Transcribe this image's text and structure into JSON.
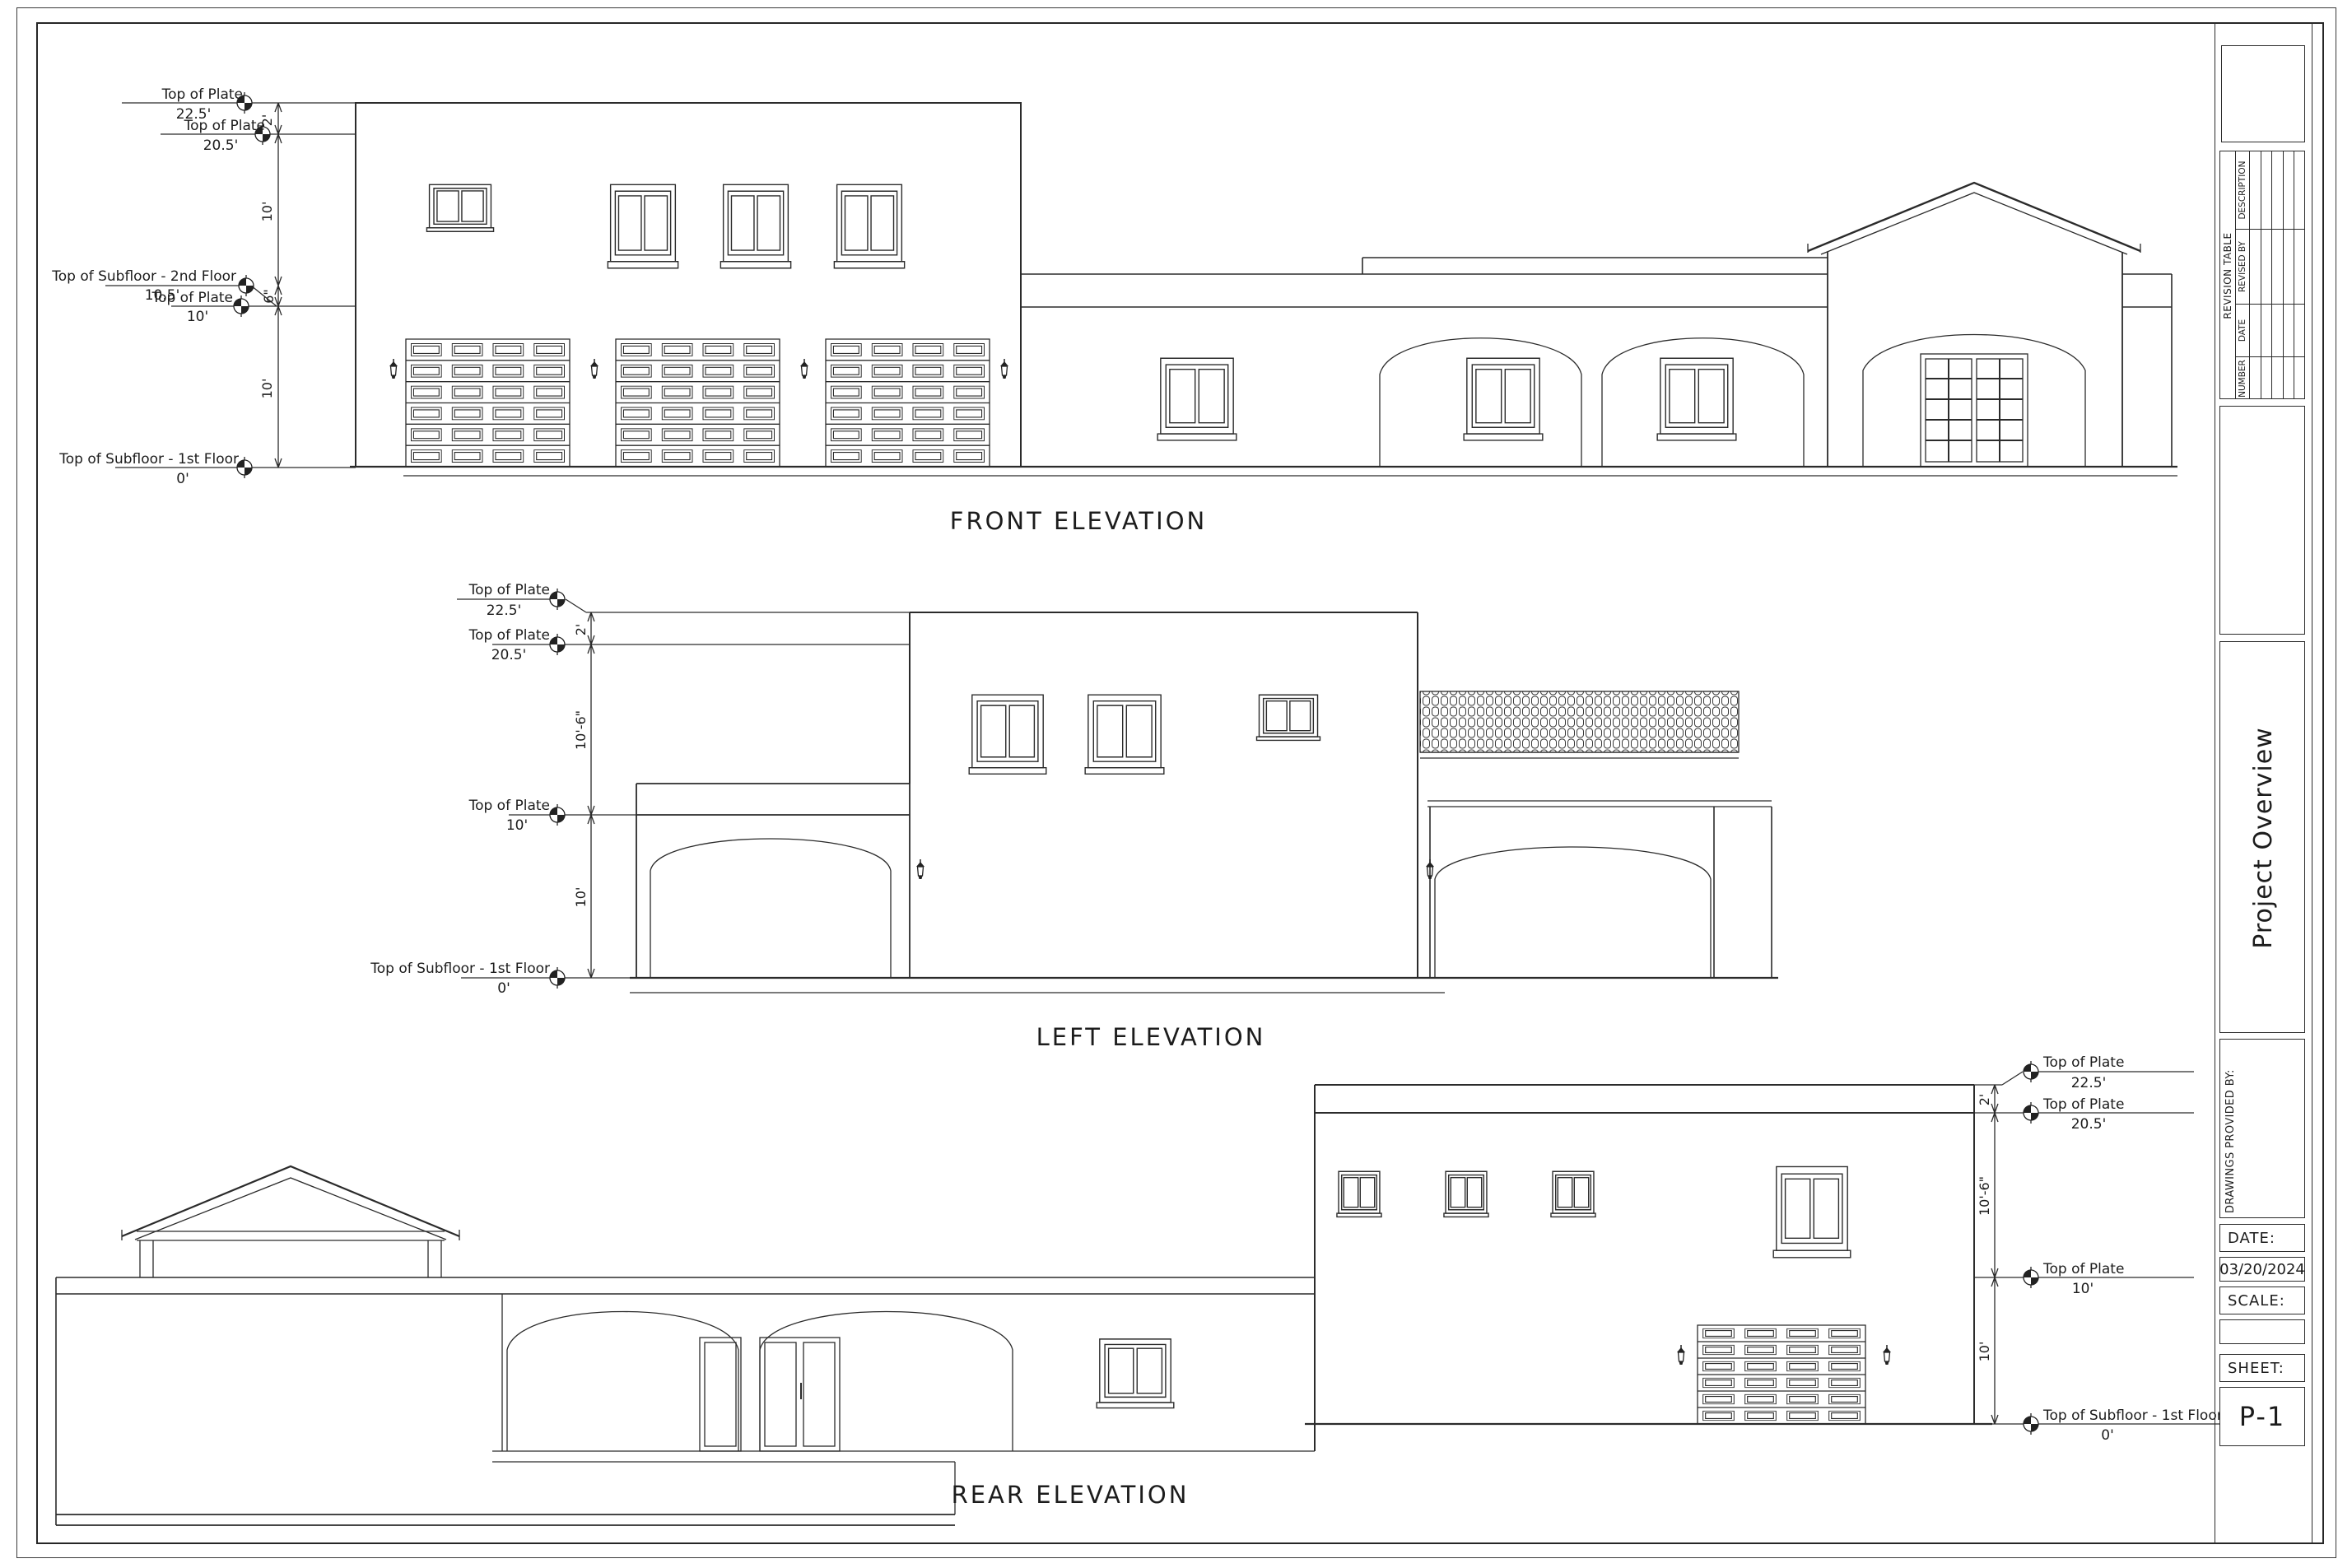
{
  "sheet": {
    "elevations": {
      "front_title": "FRONT ELEVATION",
      "left_title": "LEFT ELEVATION",
      "rear_title": "REAR ELEVATION"
    },
    "levels": {
      "top_of_plate": "Top of Plate",
      "subfloor_2nd": "Top of Subfloor - 2nd Floor",
      "subfloor_1st": "Top of Subfloor - 1st Floor",
      "v_22_5": "22.5'",
      "v_20_5": "20.5'",
      "v_10_5": "10.5'",
      "v_10": "10'",
      "v_0": "0'"
    },
    "dimensions": {
      "two_ft": "2'",
      "ten_ft": "10'",
      "six_in": "6\"",
      "ten_ft_six_in": "10'-6\""
    }
  },
  "titleblock": {
    "revision_table": {
      "title": "REVISION TABLE",
      "columns": [
        "NUMBER",
        "DATE",
        "REVISED BY",
        "DESCRIPTION"
      ],
      "empty_rows": 5
    },
    "project_title": "Project Overview",
    "drawings_provided_by": "DRAWINGS PROVIDED BY:",
    "date_label": "DATE:",
    "date_value": "03/20/2024",
    "scale_label": "SCALE:",
    "sheet_label": "SHEET:",
    "sheet_value": "P-1"
  }
}
